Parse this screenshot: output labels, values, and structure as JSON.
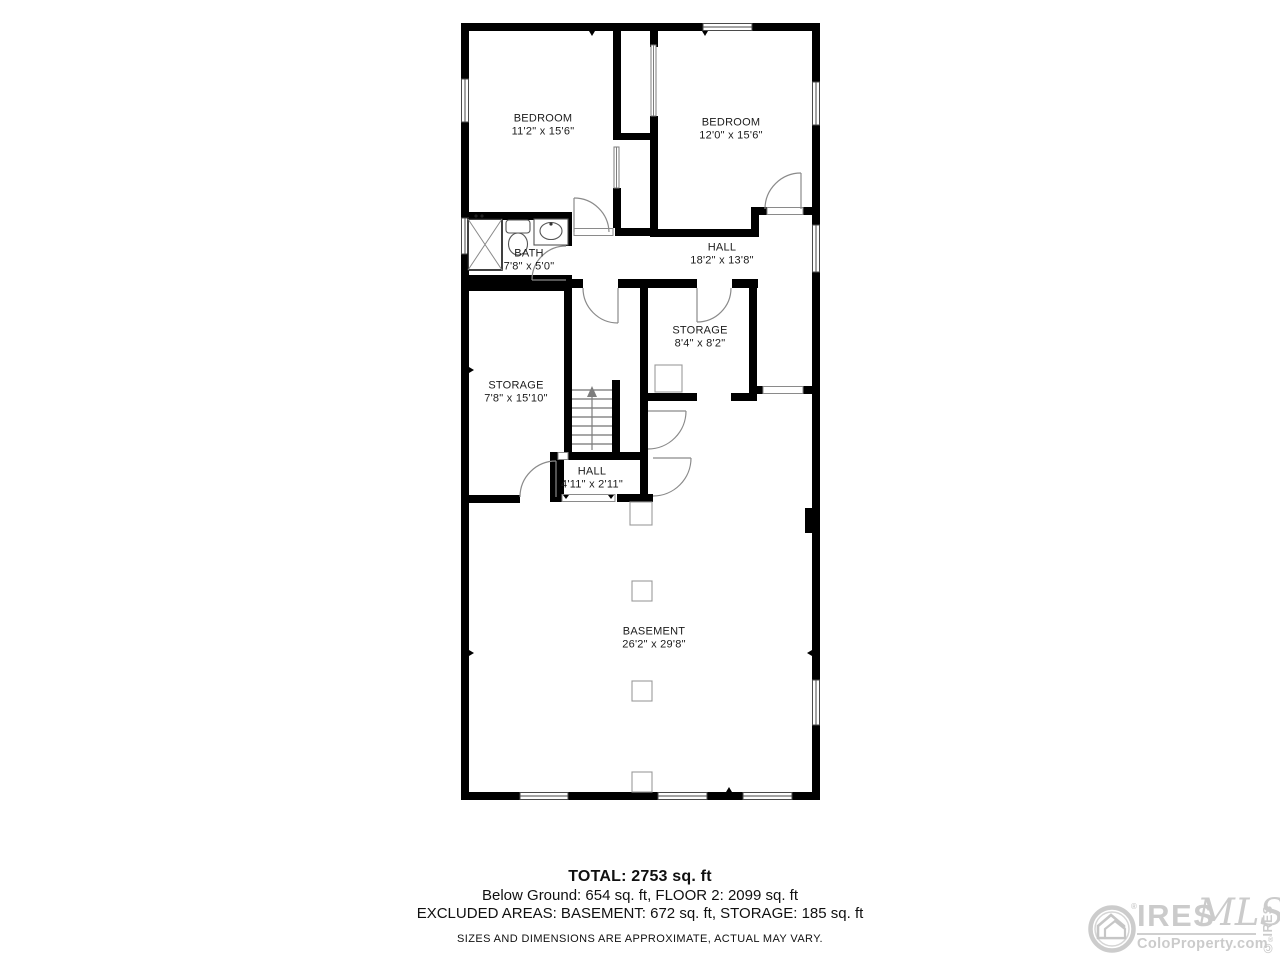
{
  "rooms": {
    "bedroom_left": {
      "label": "BEDROOM",
      "dims": "11'2\" x 15'6\""
    },
    "bedroom_right": {
      "label": "BEDROOM",
      "dims": "12'0\" x 15'6\""
    },
    "bath": {
      "label": "BATH",
      "dims": "7'8\" x 5'0\""
    },
    "hall_upper": {
      "label": "HALL",
      "dims": "18'2\" x 13'8\""
    },
    "storage_small": {
      "label": "STORAGE",
      "dims": "8'4\" x 8'2\""
    },
    "storage_large": {
      "label": "STORAGE",
      "dims": "7'8\" x 15'10\""
    },
    "hall_lower": {
      "label": "HALL",
      "dims": "4'11\" x 2'11\""
    },
    "basement": {
      "label": "BASEMENT",
      "dims": "26'2\" x 29'8\""
    }
  },
  "summary": {
    "total": "TOTAL: 2753 sq. ft",
    "floors": "Below Ground: 654 sq. ft, FLOOR 2: 2099 sq. ft",
    "excluded": "EXCLUDED AREAS: BASEMENT: 672 sq. ft, STORAGE: 185 sq. ft",
    "disclaimer": "SIZES AND DIMENSIONS ARE APPROXIMATE, ACTUAL MAY VARY."
  },
  "branding": {
    "name": "IRES",
    "mls": "MLS",
    "site": "ColoProperty.com",
    "reg": "®",
    "copyright": "© IRES",
    "gray": "#cbcbcb"
  }
}
